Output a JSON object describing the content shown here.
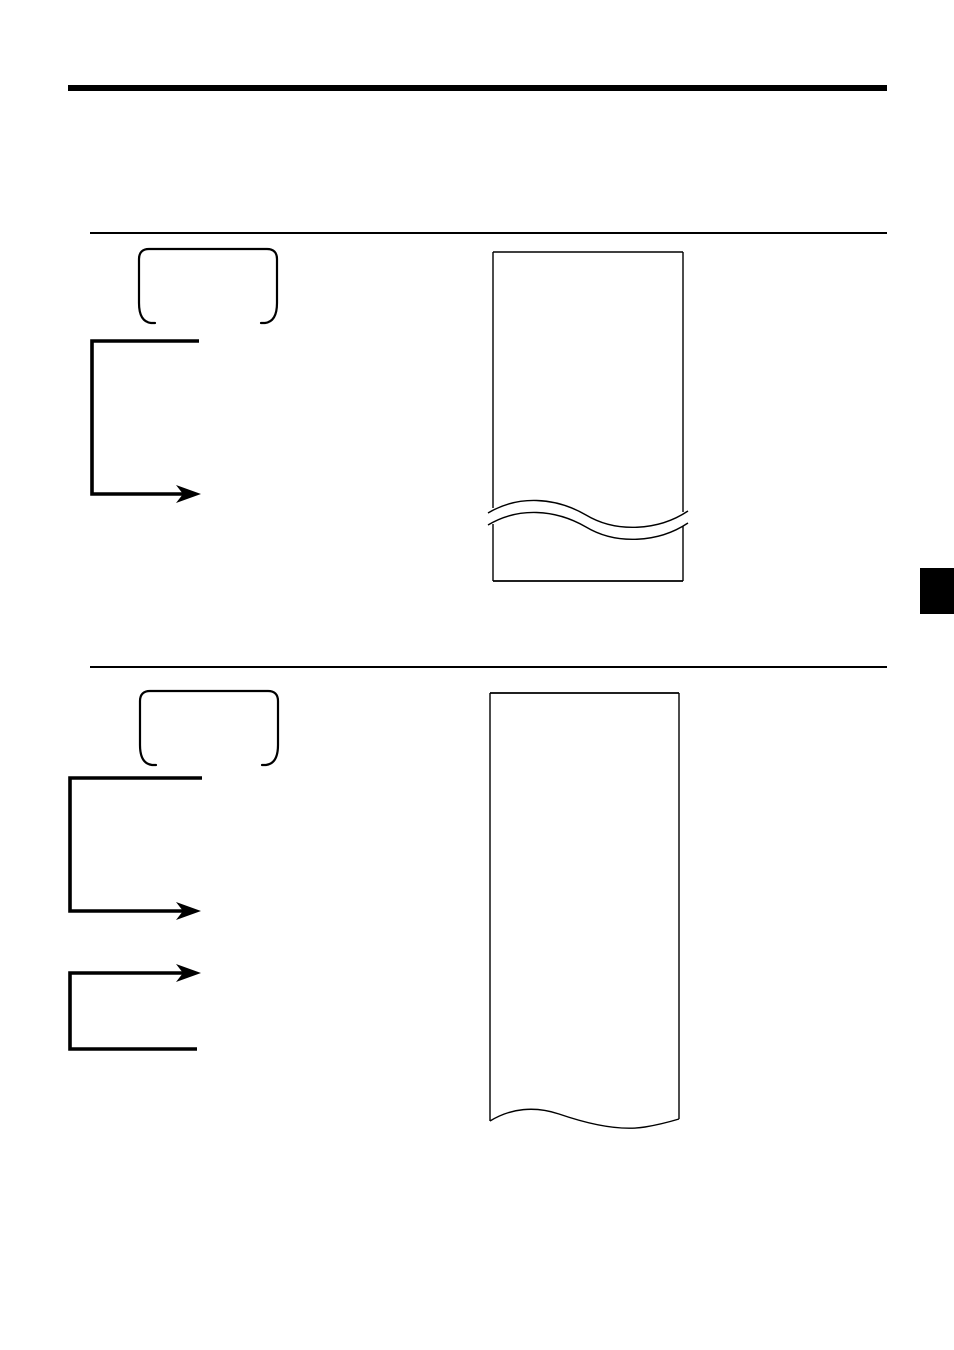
{
  "document": {
    "kind": "scanned-manual-page",
    "visible_text": "",
    "note_all_content_is_line_art": true
  },
  "colors": {
    "ink": "#000000",
    "paper": "#ffffff"
  },
  "header": {
    "rule_icon": "thick-section-rule"
  },
  "sections": [
    {
      "divider_icon": "thin-section-rule",
      "key_icon": "keycap-outline-icon",
      "flow_icons": [
        "elbow-arrow-down-right-icon"
      ],
      "receipt_icon": "receipt-paper-torn-middle-icon"
    },
    {
      "divider_icon": "thin-section-rule",
      "key_icon": "keycap-outline-icon",
      "flow_icons": [
        "elbow-arrow-down-right-icon",
        "loop-arrow-right-icon"
      ],
      "receipt_icon": "receipt-paper-torn-bottom-icon"
    }
  ],
  "page_tab": {
    "icon": "page-edge-index-tab",
    "color": "#000000"
  }
}
